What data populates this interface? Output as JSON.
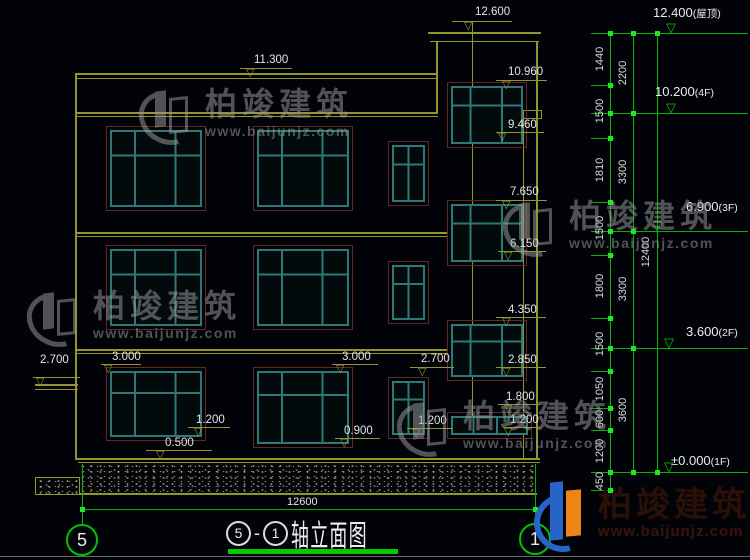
{
  "icons": {
    "tri": "▽"
  },
  "watermark": {
    "name": "柏竣建筑",
    "url": "www.baijunjz.com"
  },
  "brand": {
    "name": "柏竣建筑",
    "url": "www.baijunjz.com"
  },
  "title": {
    "left_axis": "5",
    "sep": "-",
    "right_axis": "1",
    "text": "轴立面图"
  },
  "axes": {
    "left": "5",
    "right": "1"
  },
  "dims": {
    "bottom_width": "12600",
    "total": "12400",
    "inner": [
      "1440",
      "1500",
      "1810",
      "1500",
      "1800",
      "1500",
      "1050",
      "600",
      "1200",
      "450"
    ],
    "floors": [
      "2200",
      "3300",
      "3300",
      "3600"
    ]
  },
  "levels": [
    {
      "v": "12.400",
      "s": "(屋顶)"
    },
    {
      "v": "10.200",
      "s": "(4F)"
    },
    {
      "v": "6.900",
      "s": "(3F)"
    },
    {
      "v": "3.600",
      "s": "(2F)"
    },
    {
      "v": "±0.000",
      "s": "(1F)"
    }
  ],
  "facade_marks": [
    "12.600",
    "11.300",
    "10.960",
    "9.460",
    "7.650",
    "6.150",
    "4.350",
    "2.850",
    "2.700",
    "3.000",
    "3.000",
    "2.700",
    "1.200",
    "0.500",
    "0.900",
    "1.200",
    "1.800",
    "1.200"
  ]
}
